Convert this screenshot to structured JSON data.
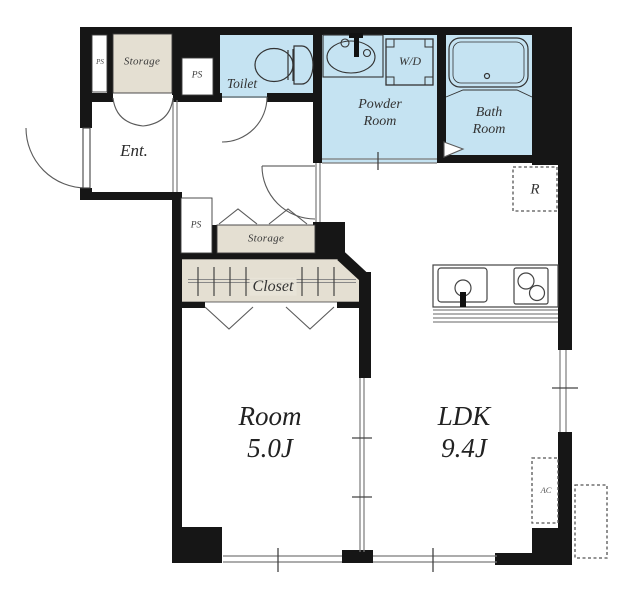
{
  "floorplan": {
    "labels": {
      "entrance": "Ent.",
      "toilet": "Toilet",
      "powder_room": [
        "Powder",
        "Room"
      ],
      "bath_room": [
        "Bath",
        "Room"
      ],
      "washer_dryer": "W/D",
      "storage_upper": "Storage",
      "storage_lower": "Storage",
      "closet": "Closet",
      "pipe_shaft_strip": "PS",
      "pipe_shaft_upper": "PS",
      "pipe_shaft_lower": "PS",
      "main_room_name": "Room",
      "main_room_size": "5.0J",
      "ldk_name": "LDK",
      "ldk_size": "9.4J",
      "refrigerator": "R",
      "air_conditioner": "AC"
    },
    "colors": {
      "wet_area_fill": "#c5e3f2",
      "storage_fill": "#e4dfd2",
      "wall": "#161616",
      "line": "#444444",
      "background": "#ffffff"
    }
  }
}
